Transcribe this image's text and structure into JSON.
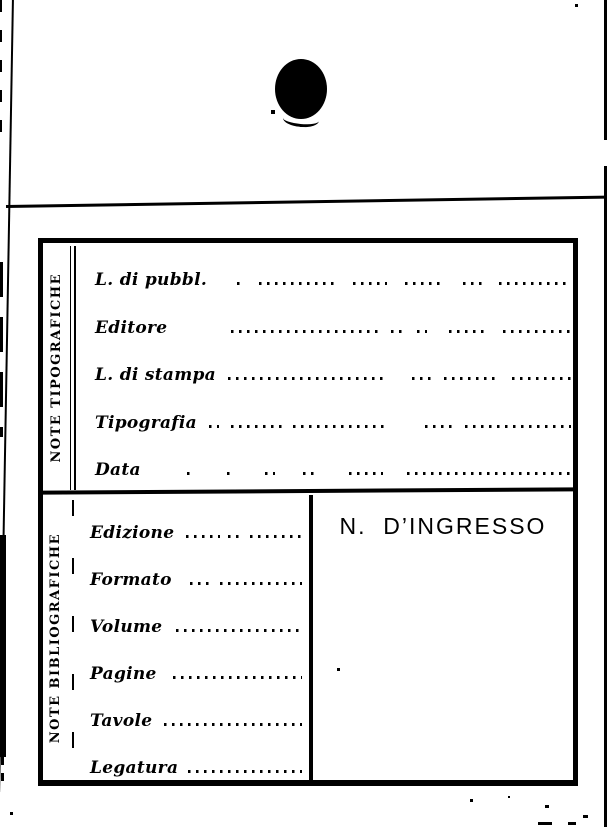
{
  "document": {
    "kind": "library-catalog-card",
    "colors": {
      "ink": "#000000",
      "paper": "#ffffff"
    },
    "sections": {
      "tipografiche": {
        "side_label": "NOTE TIPOGRAFICHE",
        "fields": [
          {
            "label": "L. di pubbl.",
            "value": ""
          },
          {
            "label": "Editore",
            "value": ""
          },
          {
            "label": "L. di stampa",
            "value": ""
          },
          {
            "label": "Tipografia",
            "value": ""
          },
          {
            "label": "Data",
            "value": ""
          }
        ]
      },
      "bibliografiche": {
        "side_label": "NOTE BIBLIOGRAFICHE",
        "fields": [
          {
            "label": "Edizione",
            "value": ""
          },
          {
            "label": "Formato",
            "value": ""
          },
          {
            "label": "Volume",
            "value": ""
          },
          {
            "label": "Pagine",
            "value": ""
          },
          {
            "label": "Tavole",
            "value": ""
          },
          {
            "label": "Legatura",
            "value": ""
          }
        ]
      },
      "ingresso": {
        "header": "N.  D’INGRESSO",
        "value": ""
      }
    }
  }
}
